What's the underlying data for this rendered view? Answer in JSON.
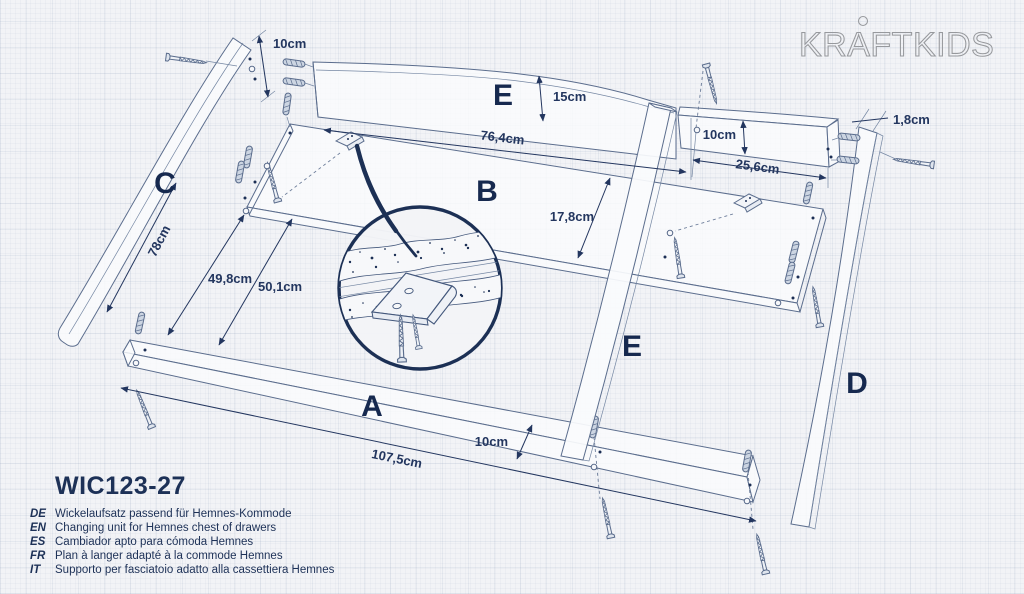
{
  "logo": {
    "text": "KRAFTKIDS"
  },
  "product": {
    "code": "WIC123-27",
    "translations": [
      {
        "lang": "DE",
        "text": "Wickelaufsatz passend für Hemnes-Kommode"
      },
      {
        "lang": "EN",
        "text": "Changing unit for Hemnes chest of drawers"
      },
      {
        "lang": "ES",
        "text": "Cambiador apto para cómoda Hemnes"
      },
      {
        "lang": "FR",
        "text": "Plan à langer adapté à la commode Hemnes"
      },
      {
        "lang": "IT",
        "text": "Supporto per fasciatoio adatto alla cassettiera Hemnes"
      }
    ]
  },
  "diagram": {
    "part_labels": {
      "a": "A",
      "b": "B",
      "c": "C",
      "d": "D",
      "e": "E"
    },
    "dimensions": {
      "top_left_gap": "10cm",
      "back_panel_height": "15cm",
      "back_panel_length": "76,4cm",
      "right_panel_height": "10cm",
      "right_panel_length": "25,6cm",
      "board_thickness": "1,8cm",
      "shelf_depth": "17,8cm",
      "side_rail_length": "78cm",
      "left_gap_front": "49,8cm",
      "left_gap_back": "50,1cm",
      "front_rail_width": "10cm",
      "front_rail_length": "107,5cm"
    }
  },
  "colors": {
    "accent_navy": "#1c3055",
    "drawing_line": "#5b6d8d",
    "paper": "#f2f3f6",
    "logo_gray": "#97999d"
  }
}
